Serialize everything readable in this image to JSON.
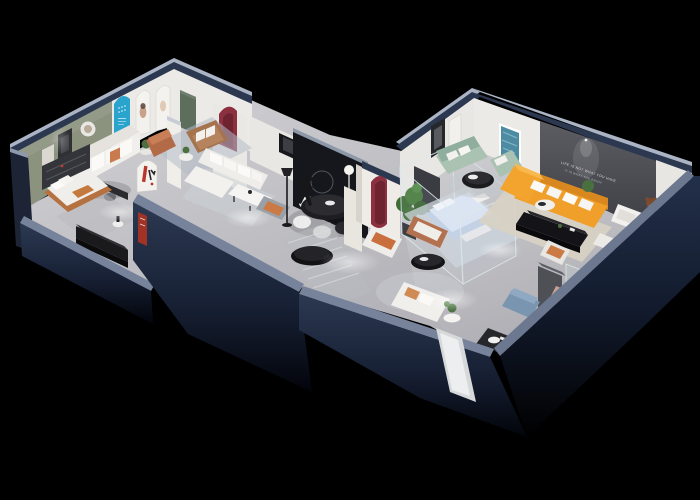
{
  "image": {
    "kind": "3d-isometric-floorplan-cutaway-render",
    "subject": "Furniture showroom apartment, dollhouse cutaway with navy walls on black background",
    "background": "#000000"
  },
  "wall_slogan": {
    "line1": "LIFE IS NOT WHAT YOU HAVE",
    "line2": "IT IS WHAT YOU ENJOY"
  },
  "palette": {
    "outer_wall_navy": "#26324a",
    "outer_wall_dark": "#121a2a",
    "wall_top_light": "#a6b1c2",
    "floor_gray": "#c6c6ca",
    "accent_wall_sage": "#8b927e",
    "accent_wall_charcoal": "#4a4b51",
    "arch_blue": "#2aa3cd",
    "arch_maroon": "#8c3040",
    "door_green": "#5e6e5c",
    "sofa_orange": "#f09f2b",
    "sofa_mint": "#a9c2b1",
    "sofa_cognac": "#b4714f",
    "sofa_white": "#f1efec",
    "bed_blue": "#c2d0e4",
    "plant_green": "#4a7040",
    "bear_brown": "#7c4a2c"
  },
  "rooms": [
    {
      "name": "gallery lounge",
      "features": [
        "sage green accent wall with frames and round mirror",
        "blue arched display niche",
        "white arched niches with portraits",
        "green door",
        "white sofa with orange pillows",
        "black writing desk",
        "copper ottoman",
        "tan leather loveseat",
        "side table with plant"
      ]
    },
    {
      "name": "bedroom display",
      "features": [
        "bed with cognac leather base",
        "dark wall shelving",
        "glossy black media sideboard",
        "white side table"
      ]
    },
    {
      "name": "living display",
      "features": [
        "white L-sectional with pillows",
        "white coffee table",
        "gray armchair with orange cushion",
        "black floor lamp",
        "black round dining table",
        "white dining chairs",
        "white globe floor lamp"
      ]
    },
    {
      "name": "entry corridor",
      "features": [
        "white pillar with maroon arch niche",
        "dancer sculpture",
        "wall ring",
        "striped runner rug",
        "black oval bench",
        "ficus plant",
        "freestanding arch sign with red logo",
        "red banner on navy wall",
        "entry door panel"
      ]
    },
    {
      "name": "main showroom",
      "features": [
        "charcoal feature wall with slogan and downlight",
        "orange L-sectional with white pillows",
        "black media console",
        "round white coffee table",
        "mint green sofa and chaise",
        "black round coffee table",
        "teal abstract painting",
        "framed art pair",
        "glass-walled bedroom with pale blue bed",
        "cognac loveseat",
        "black oval coffee table",
        "white sofa group",
        "white armchair",
        "teddy-bear figure",
        "white side tables",
        "gray wardrobe",
        "glass plant display case",
        "blue ottoman",
        "blush armchair",
        "dark bookshelf mat"
      ]
    }
  ]
}
